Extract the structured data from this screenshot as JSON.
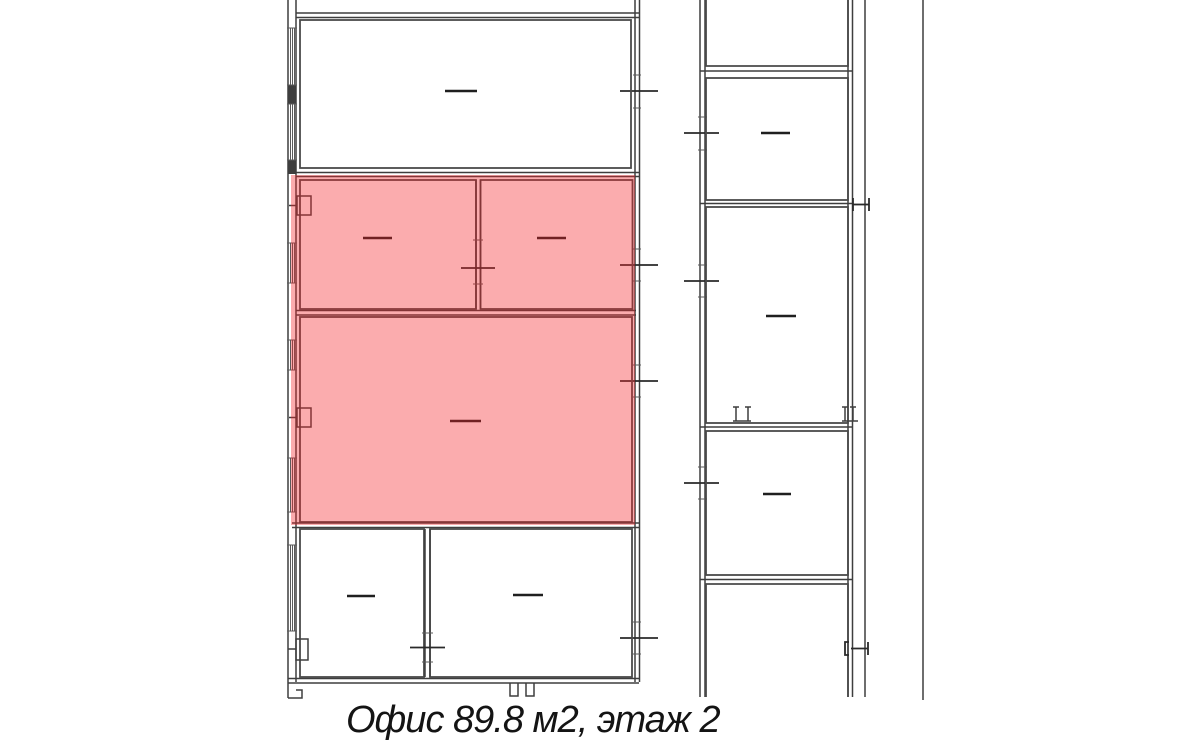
{
  "caption": {
    "text": "Офис 89.8 м2, этаж 2",
    "area_m2": "89.8",
    "floor": "2"
  },
  "colors": {
    "background": "#ffffff",
    "wall": "#3e3e3e",
    "highlight_overlay": "rgba(244,37,42,0.38)",
    "highlight_fill_result": "#FBACAE",
    "caption_text": "#141414"
  },
  "plan": {
    "highlighted_room_count": 3,
    "left_building_room_count": 6,
    "right_building_room_count": 5,
    "room_labels_redacted": true
  }
}
